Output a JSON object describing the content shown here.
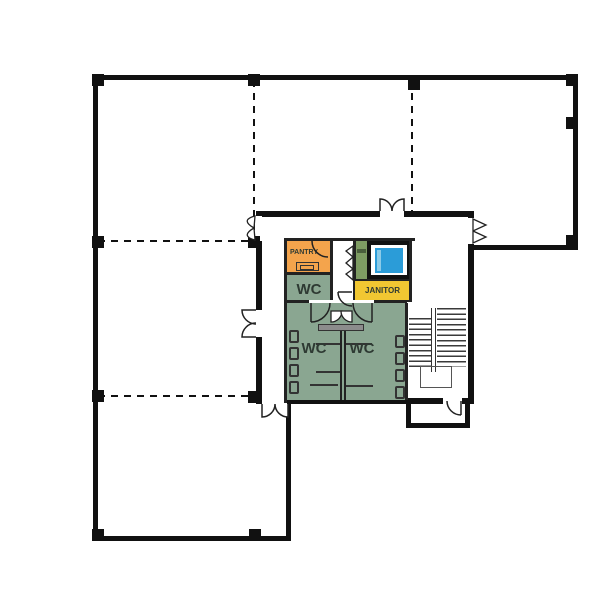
{
  "type": "floor-plan",
  "rooms": {
    "pantry": {
      "label": "PANTRY",
      "color": "#F4A44C"
    },
    "wc_upper": {
      "label": "WC",
      "color": "#8AA691"
    },
    "wc_left": {
      "label": "WC",
      "color": "#8AA691"
    },
    "wc_right": {
      "label": "WC",
      "color": "#8AA691"
    },
    "janitor": {
      "label": "JANITOR",
      "color": "#F1C732"
    },
    "shaft": {
      "label": "",
      "color": "#7E9C63"
    },
    "elevator": {
      "color": "#2B9CD8",
      "door_color": "#8CCBE8"
    }
  },
  "colors": {
    "wall": "#111111",
    "inner_wall": "#222222",
    "counter": "#8C8C8C",
    "background": "#FFFFFF"
  }
}
